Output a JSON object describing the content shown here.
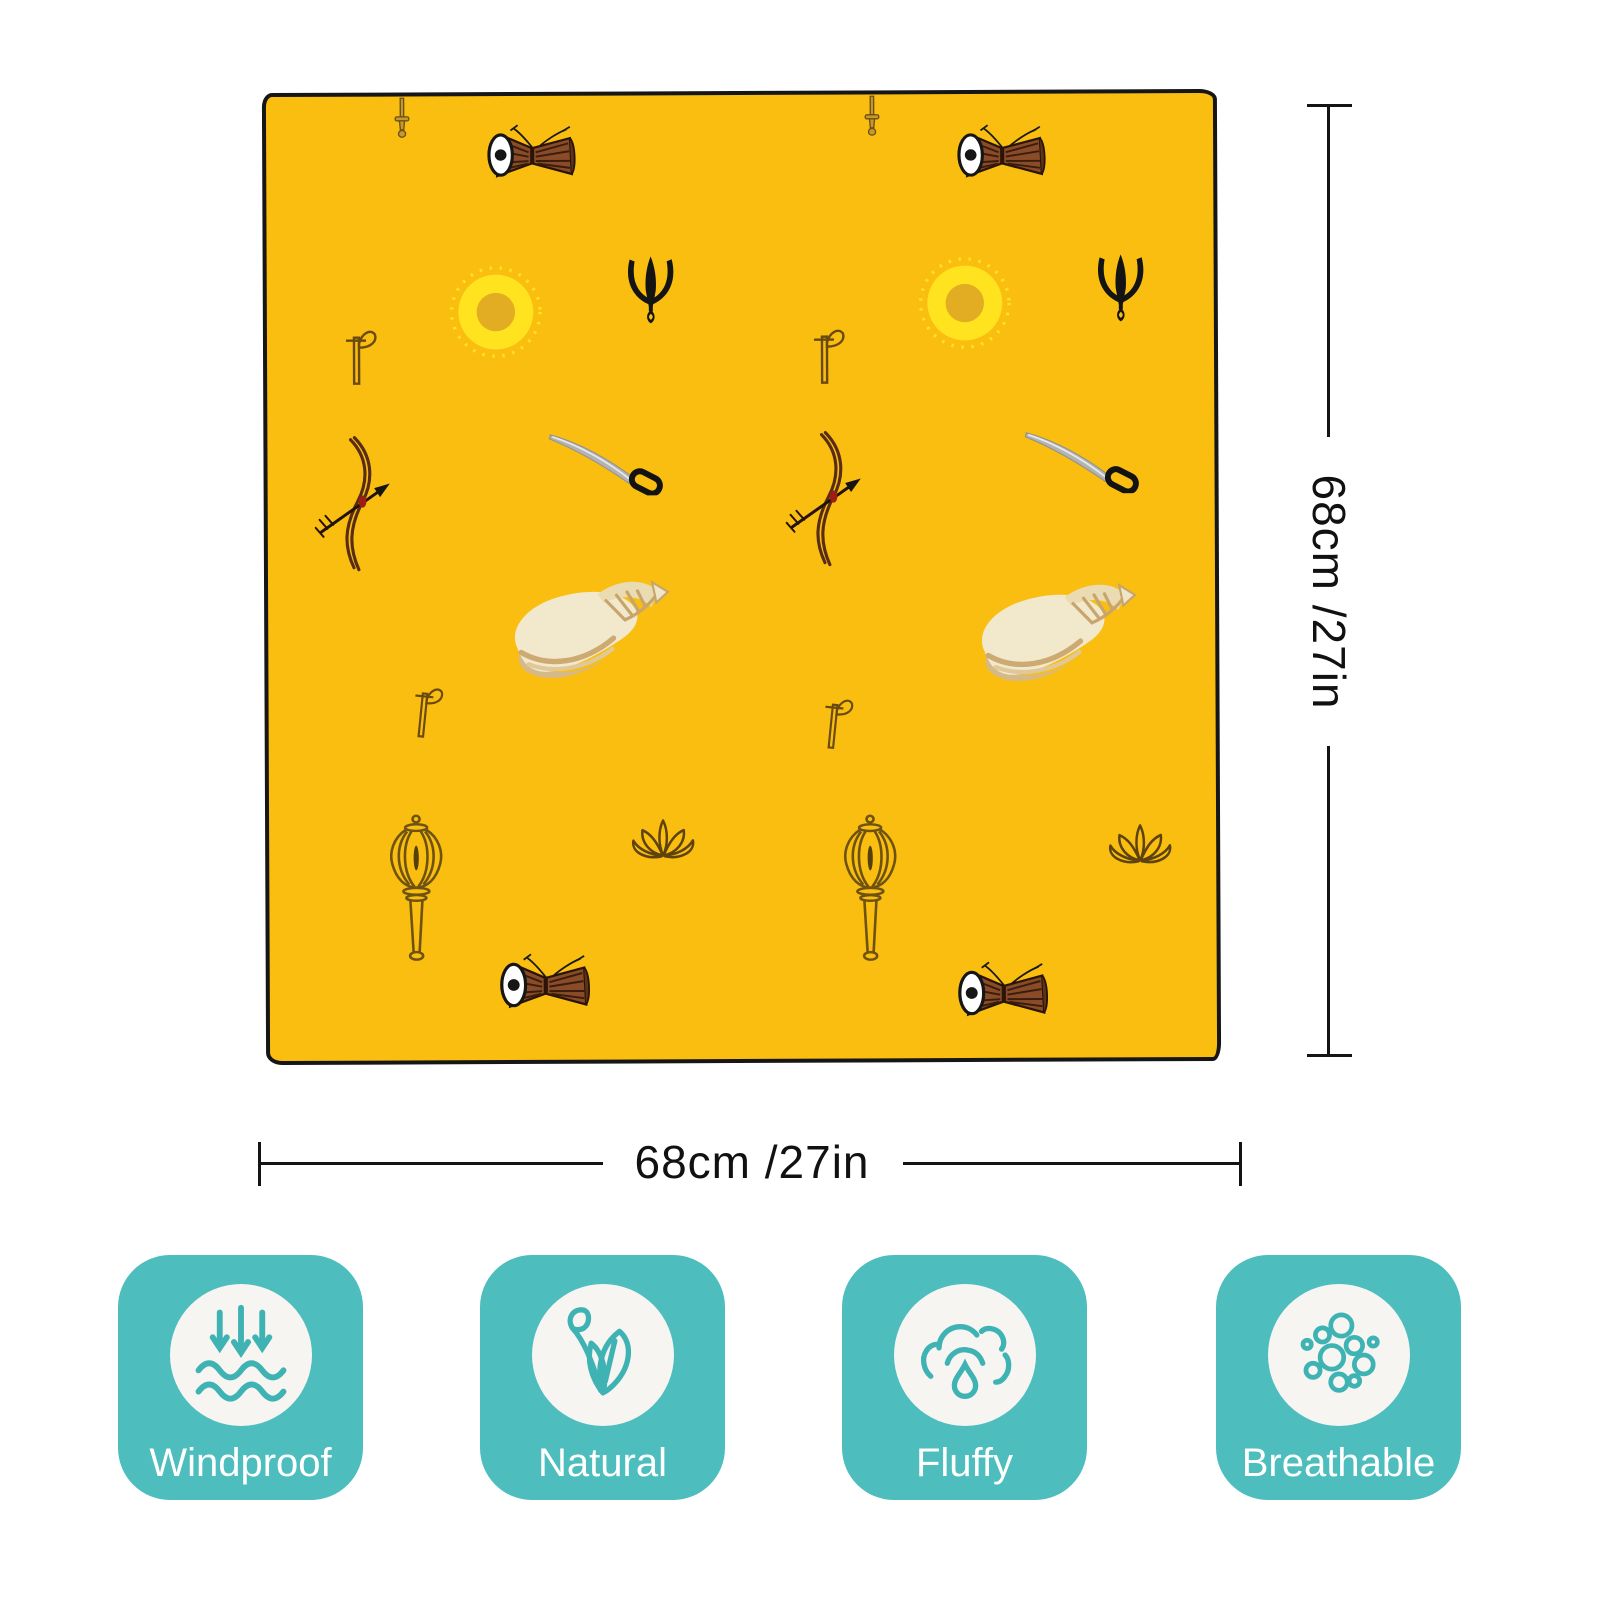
{
  "bandana": {
    "fabric_color": "#F9BE0F",
    "pattern_symbols": [
      "dagger",
      "damaru-drum",
      "sun",
      "trishul-trident",
      "axe",
      "bow-and-arrow",
      "sword",
      "conch-shell",
      "mace-gada",
      "lotus"
    ]
  },
  "dimensions": {
    "height_label": "68cm /27in",
    "width_label": "68cm /27in"
  },
  "features": [
    {
      "label": "Windproof",
      "icon": "wind-arrows-over-waves"
    },
    {
      "label": "Natural",
      "icon": "leaf-sprout"
    },
    {
      "label": "Fluffy",
      "icon": "cloud-with-droplet"
    },
    {
      "label": "Breathable",
      "icon": "bubbles"
    }
  ],
  "colors": {
    "background": "#FFFFFF",
    "fabric_yellow": "#F9BE0F",
    "outline_black": "#1A1A1A",
    "badge_teal": "#4DBDBD",
    "badge_icon_teal": "#3FB3B3",
    "badge_text": "#FFFFFF",
    "dimension_text": "#111111"
  }
}
